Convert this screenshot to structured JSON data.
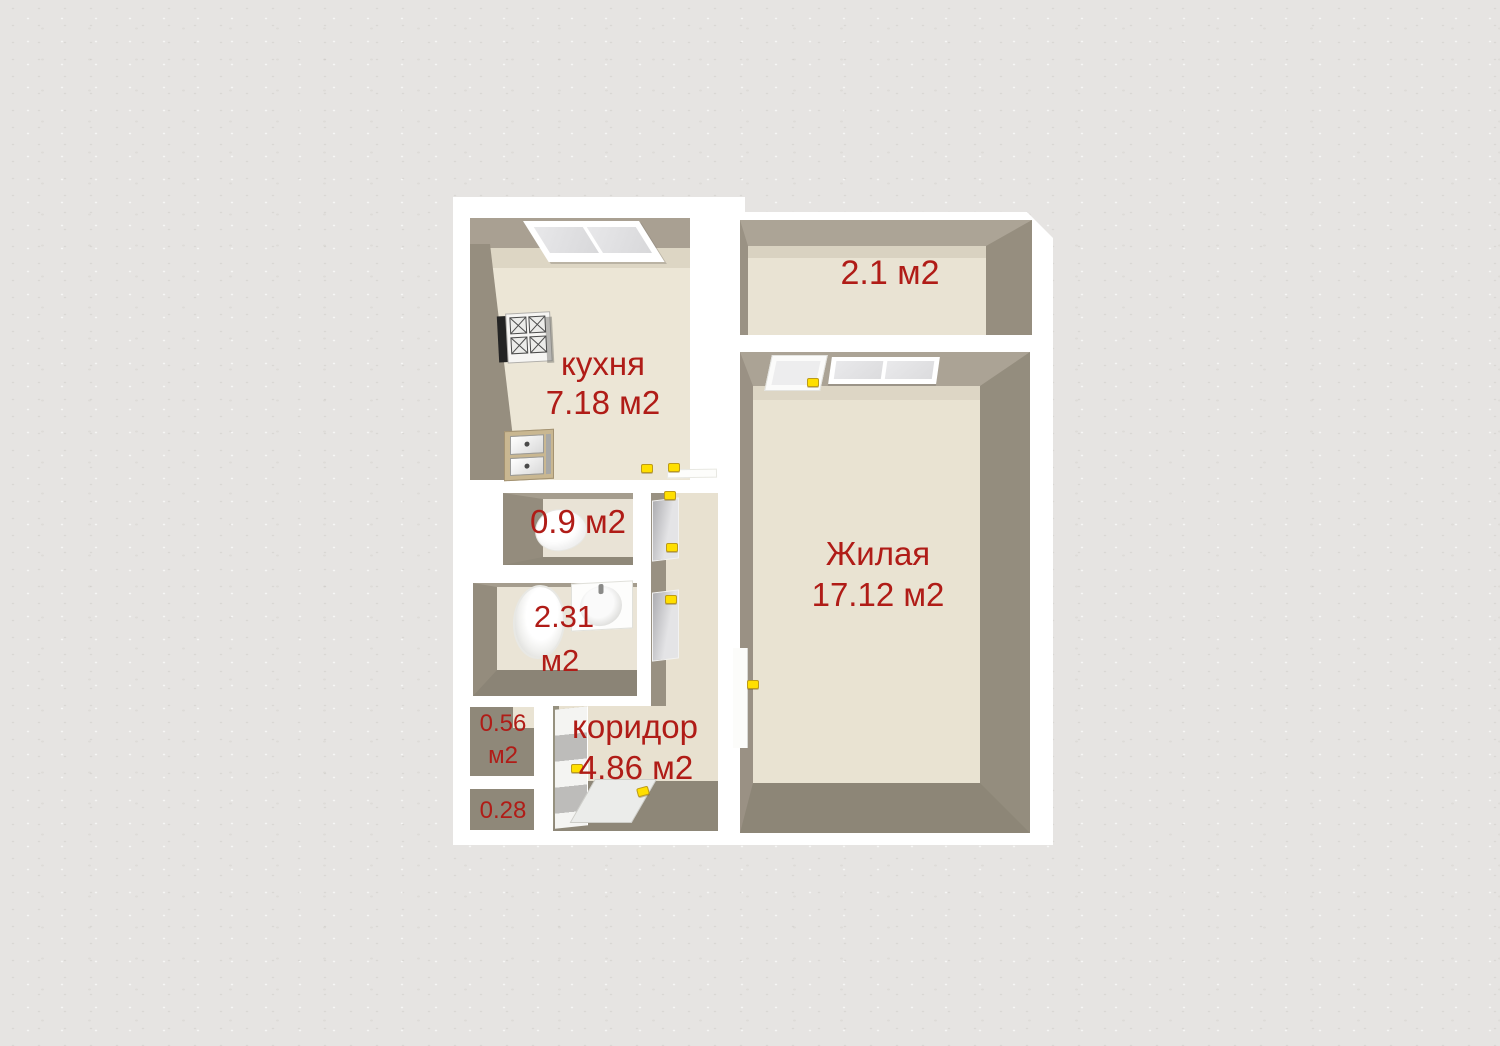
{
  "floor_plan": {
    "rooms": {
      "kitchen": {
        "name": "кухня",
        "area": "7.18 м2"
      },
      "balcony": {
        "area": "2.1 м2"
      },
      "living_room": {
        "name": "Жилая",
        "area": "17.12 м2"
      },
      "toilet": {
        "area": "0.9 м2"
      },
      "bathroom": {
        "area_value": "2.31",
        "area_unit": "м2"
      },
      "storage_upper": {
        "area_value": "0.56",
        "area_unit": "м2"
      },
      "storage_lower": {
        "area": "0.28"
      },
      "corridor": {
        "name": "коридор",
        "area": "4.86 м2"
      }
    },
    "colors": {
      "background": "#e6e4e2",
      "wall_outline": "#ffffff",
      "wall_face_dark": "#948d7e",
      "wall_face_light": "#a9a192",
      "floor": "#e9e3d2",
      "label_text": "#b01c17",
      "door_handle": "#ffdf00"
    },
    "fixtures": [
      "stove-icon",
      "kitchen-sink-icon",
      "toilet-icon",
      "bathtub-icon",
      "washbasin-icon",
      "window-icon",
      "balcony-door-icon",
      "interior-door-icon",
      "entrance-door-icon"
    ]
  }
}
